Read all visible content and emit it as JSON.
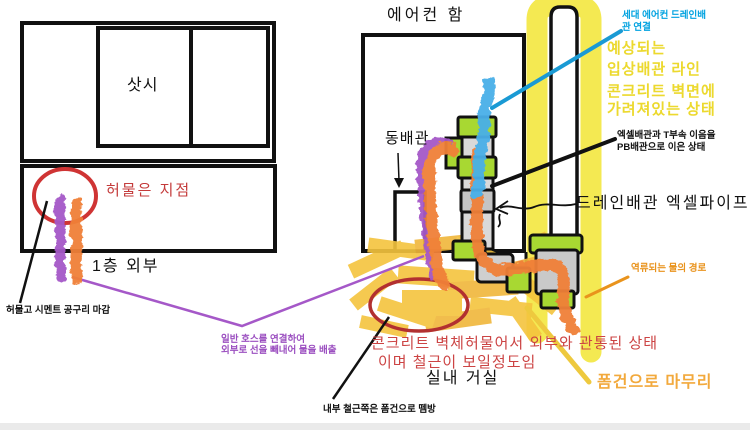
{
  "labels": {
    "aircon_box": "에어컨 함",
    "sash": "삿시",
    "copper_pipe": "동배관",
    "demolished_point": "허물은 지점",
    "first_floor": "1층 외부",
    "cement_note": "허물고 시멘트 공구리 마감",
    "hose_note": {
      "lines": [
        "일반 호스를 연결하여",
        "외부로 선을 빼내어 물을 배출"
      ]
    },
    "unit_drain_note": {
      "lines": [
        "세대 에어컨 드레인배",
        "관 연결"
      ]
    },
    "riser_note": {
      "lines": [
        "예상되는",
        "입상배관 라인",
        "콘크리트 벽면에",
        "가려져있는 상태"
      ]
    },
    "pb_note": {
      "lines": [
        "엑셀배관과 T부속 이음을",
        "PB배관으로 이은 상태"
      ]
    },
    "drain_pipe": "드레인배관 엑셀파이프",
    "backflow": "역류되는 물의 경로",
    "concrete_note": {
      "lines": [
        "콘크리트 벽체허물어서 외부와 관통된 상태",
        "이며 철근이 보일정도임"
      ]
    },
    "living_room": "실내 거실",
    "foam_finish": "폼건으로 마무리",
    "rebar_note": "내부 철근쪽은 폼건으로 뗌방"
  },
  "colors": {
    "ink": "#111111",
    "red_line": "#cf3434",
    "red_text": "#c43b3b",
    "dark_red": "#b23030",
    "concrete_red": "#cc4444",
    "purple": "#a558c8",
    "purple_text": "#9b4fc0",
    "orange_pipe": "#f08038",
    "orange_text": "#e9931c",
    "foam_text": "#f2a93c",
    "blue": "#4aafe8",
    "cyan": "#1a9ad4",
    "cyan_text": "#00a2e0",
    "yellow_hl": "#f2e534",
    "yellow_text": "#ecd92e",
    "foam": "#f5c43e",
    "foam_line": "#eec93e",
    "green": "#a8d832",
    "pipe_gray": "#c9c9c9",
    "pipe_body": "#d9d9d9"
  }
}
